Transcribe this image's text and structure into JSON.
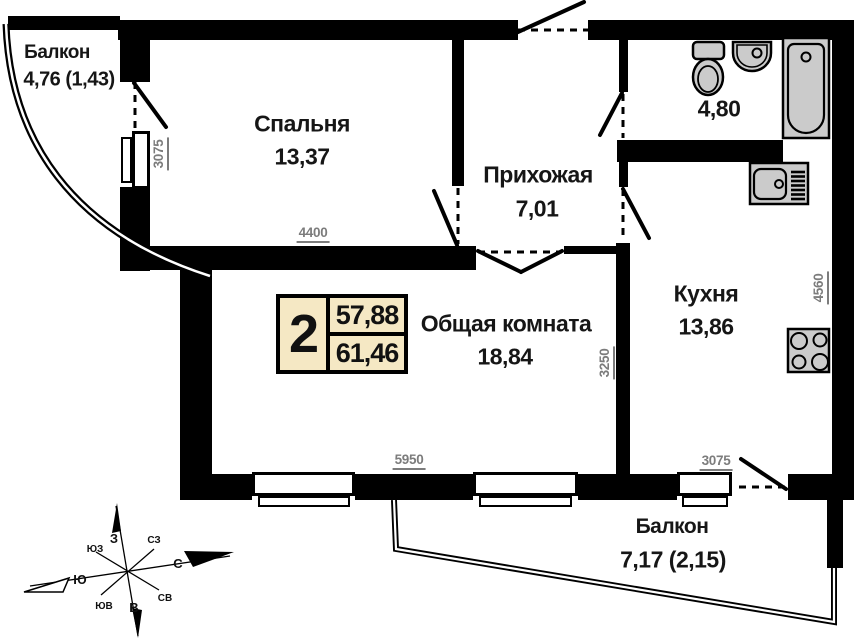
{
  "plan": {
    "badge": {
      "rooms": "2",
      "living_area": "57,88",
      "total_area": "61,46"
    },
    "rooms": {
      "balcony_top": {
        "name": "Балкон",
        "area": "4,76 (1,43)"
      },
      "bedroom": {
        "name": "Спальня",
        "area": "13,37"
      },
      "hallway": {
        "name": "Прихожая",
        "area": "7,01"
      },
      "bathroom": {
        "area": "4,80"
      },
      "kitchen": {
        "name": "Кухня",
        "area": "13,86"
      },
      "living_room": {
        "name": "Общая комната",
        "area": "18,84"
      },
      "balcony_bottom": {
        "name": "Балкон",
        "area": "7,17 (2,15)"
      }
    },
    "dimensions": {
      "bedroom_window": "3075",
      "bedroom_width": "4400",
      "living_kitchen_wall": "3250",
      "living_width": "5950",
      "kitchen_height": "4560",
      "kitchen_width": "3075"
    },
    "compass": {
      "n": "С",
      "s": "Ю",
      "w": "З",
      "e": "В",
      "nw": "СЗ",
      "ne": "СВ",
      "sw": "ЮЗ",
      "se": "ЮВ"
    },
    "colors": {
      "wall": "#000000",
      "fixture_fill": "#cbcbcb",
      "badge_bg": "#f5e8c4",
      "dimension_text": "#7c7c7c"
    }
  }
}
